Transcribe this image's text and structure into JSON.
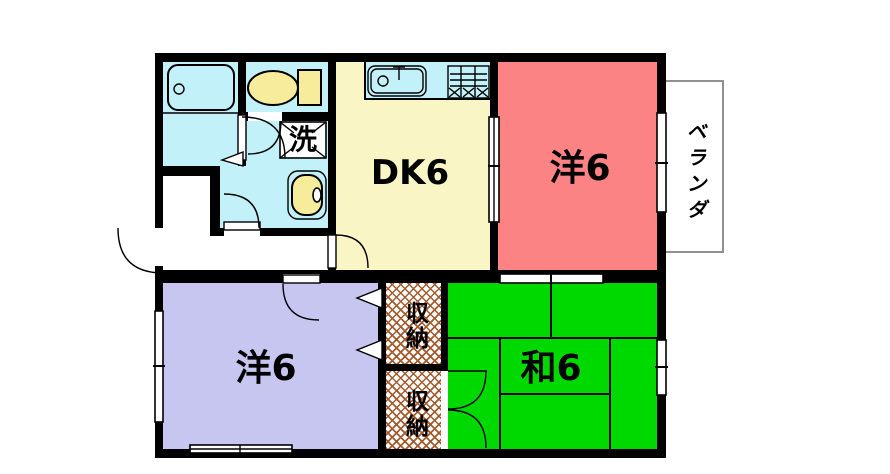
{
  "rooms": {
    "dk": {
      "label": "DK6"
    },
    "western_top": {
      "label": "洋6"
    },
    "western_bottom": {
      "label": "洋6"
    },
    "japanese": {
      "label": "和6"
    },
    "storage_upper": {
      "label": "収納"
    },
    "storage_lower": {
      "label": "収納"
    },
    "laundry": {
      "label": "洗"
    },
    "veranda": {
      "label": "ベランダ"
    }
  },
  "icons": [
    "bathtub-icon",
    "toilet-icon",
    "kitchen-sink-icon",
    "gas-stove-icon",
    "washbasin-icon",
    "washing-machine-pan-icon"
  ],
  "colors": {
    "wall": "#000000",
    "water_rooms": "#C2F1F9",
    "dk": "#FAF5C4",
    "western_top": "#FB8384",
    "western_bottom": "#C7C6F0",
    "japanese": "#00D900",
    "storage_hatch": "#A35A2D",
    "fixture_yellow": "#F6EC9B",
    "veranda_border": "#909090"
  }
}
